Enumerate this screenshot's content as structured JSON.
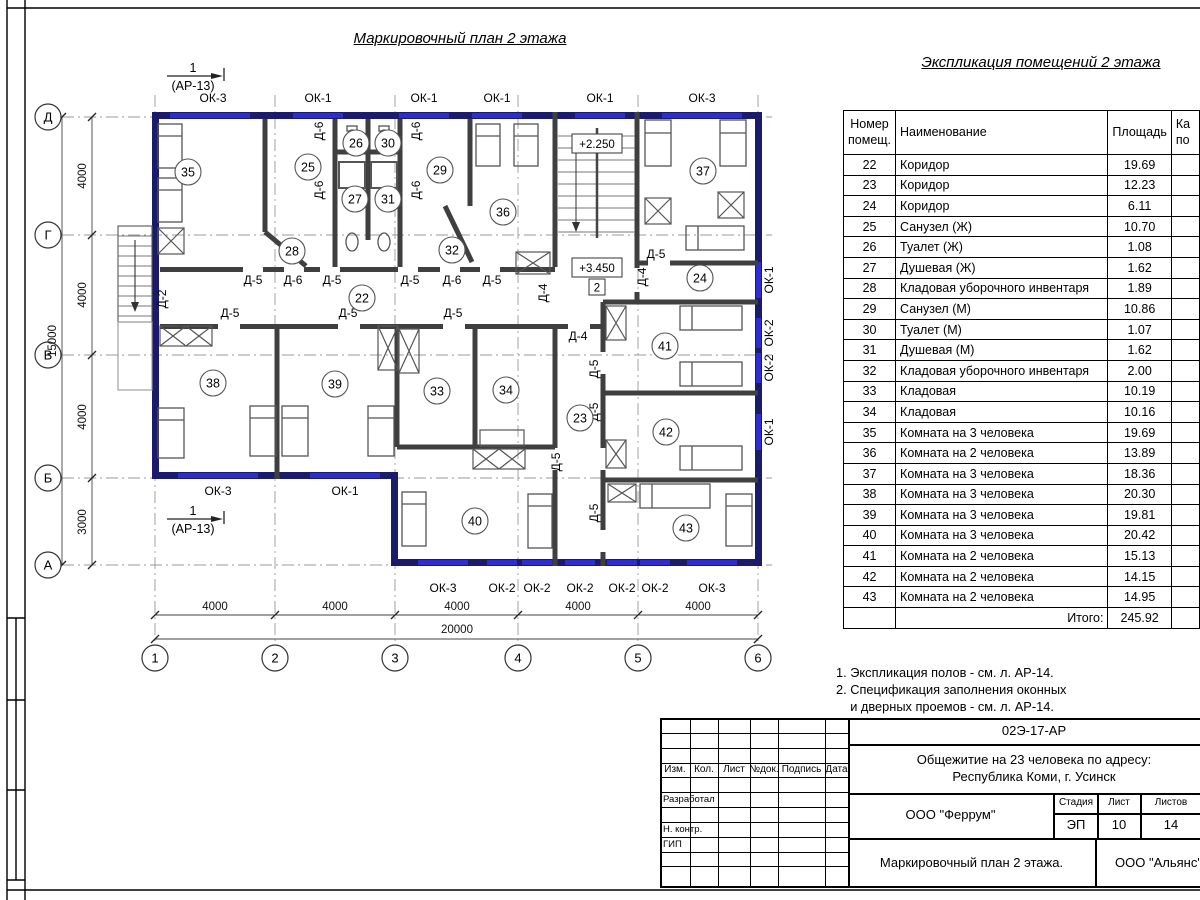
{
  "sheet": {
    "plan_title": "Маркировочный план 2 этажа",
    "schedule_title": "Экспликация помещений 2 этажа"
  },
  "plan": {
    "section_marker": {
      "num": "1",
      "ref": "(АР-13)",
      "positions": [
        {
          "x": 197,
          "y": 76
        },
        {
          "x": 197,
          "y": 519
        }
      ]
    },
    "axis_rows": [
      {
        "label": "Д",
        "y": 117
      },
      {
        "label": "Г",
        "y": 235
      },
      {
        "label": "В",
        "y": 355
      },
      {
        "label": "Б",
        "y": 478
      },
      {
        "label": "А",
        "y": 565
      }
    ],
    "axis_cols": [
      {
        "label": "1",
        "x": 155
      },
      {
        "label": "2",
        "x": 275
      },
      {
        "label": "3",
        "x": 395
      },
      {
        "label": "4",
        "x": 518
      },
      {
        "label": "5",
        "x": 638
      },
      {
        "label": "6",
        "x": 758
      }
    ],
    "dims_left_segments": [
      {
        "t": "4000",
        "y": 176
      },
      {
        "t": "4000",
        "y": 295
      },
      {
        "t": "4000",
        "y": 417
      },
      {
        "t": "3000",
        "y": 522
      }
    ],
    "dim_left_total": {
      "t": "15000",
      "x": 56,
      "y": 341
    },
    "dims_bottom_segments": [
      {
        "t": "4000",
        "x": 215
      },
      {
        "t": "4000",
        "x": 335
      },
      {
        "t": "4000",
        "x": 457
      },
      {
        "t": "4000",
        "x": 578
      },
      {
        "t": "4000",
        "x": 698
      }
    ],
    "dim_bottom_total": {
      "t": "20000",
      "x": 457,
      "y": 633
    },
    "rooms": [
      {
        "num": "35",
        "x": 188,
        "y": 172
      },
      {
        "num": "25",
        "x": 308,
        "y": 167
      },
      {
        "num": "26",
        "x": 356,
        "y": 143
      },
      {
        "num": "30",
        "x": 388,
        "y": 143
      },
      {
        "num": "27",
        "x": 355,
        "y": 199
      },
      {
        "num": "31",
        "x": 388,
        "y": 199
      },
      {
        "num": "29",
        "x": 440,
        "y": 170
      },
      {
        "num": "36",
        "x": 503,
        "y": 212
      },
      {
        "num": "28",
        "x": 292,
        "y": 251
      },
      {
        "num": "32",
        "x": 452,
        "y": 250
      },
      {
        "num": "22",
        "x": 362,
        "y": 298
      },
      {
        "num": "37",
        "x": 703,
        "y": 171
      },
      {
        "num": "24",
        "x": 700,
        "y": 278
      },
      {
        "num": "41",
        "x": 665,
        "y": 346
      },
      {
        "num": "42",
        "x": 666,
        "y": 432
      },
      {
        "num": "43",
        "x": 686,
        "y": 528
      },
      {
        "num": "40",
        "x": 475,
        "y": 521
      },
      {
        "num": "38",
        "x": 213,
        "y": 383
      },
      {
        "num": "39",
        "x": 335,
        "y": 384
      },
      {
        "num": "33",
        "x": 437,
        "y": 391
      },
      {
        "num": "34",
        "x": 506,
        "y": 390
      },
      {
        "num": "23",
        "x": 580,
        "y": 418
      }
    ],
    "window_labels": [
      {
        "t": "ОК-3",
        "x": 213,
        "y": 102
      },
      {
        "t": "ОК-1",
        "x": 318,
        "y": 102
      },
      {
        "t": "ОК-1",
        "x": 424,
        "y": 102
      },
      {
        "t": "ОК-1",
        "x": 497,
        "y": 102
      },
      {
        "t": "ОК-1",
        "x": 600,
        "y": 102
      },
      {
        "t": "ОК-3",
        "x": 702,
        "y": 102
      },
      {
        "t": "ОК-3",
        "x": 218,
        "y": 495
      },
      {
        "t": "ОК-1",
        "x": 345,
        "y": 495
      },
      {
        "t": "ОК-3",
        "x": 443,
        "y": 592
      },
      {
        "t": "ОК-2",
        "x": 502,
        "y": 592
      },
      {
        "t": "ОК-2",
        "x": 537,
        "y": 592
      },
      {
        "t": "ОК-2",
        "x": 580,
        "y": 592
      },
      {
        "t": "ОК-2",
        "x": 622,
        "y": 592
      },
      {
        "t": "ОК-2",
        "x": 655,
        "y": 592
      },
      {
        "t": "ОК-3",
        "x": 712,
        "y": 592
      },
      {
        "t": "ОК-1",
        "x": 773,
        "y": 280,
        "r": 1
      },
      {
        "t": "ОК-2",
        "x": 773,
        "y": 333,
        "r": 1
      },
      {
        "t": "ОК-2",
        "x": 773,
        "y": 368,
        "r": 1
      },
      {
        "t": "ОК-1",
        "x": 773,
        "y": 432,
        "r": 1
      }
    ],
    "door_labels": [
      {
        "t": "Д-5",
        "x": 253,
        "y": 284
      },
      {
        "t": "Д-6",
        "x": 293,
        "y": 284
      },
      {
        "t": "Д-5",
        "x": 332,
        "y": 284
      },
      {
        "t": "Д-5",
        "x": 410,
        "y": 284
      },
      {
        "t": "Д-6",
        "x": 452,
        "y": 284
      },
      {
        "t": "Д-5",
        "x": 492,
        "y": 284
      },
      {
        "t": "Д-5",
        "x": 230,
        "y": 317
      },
      {
        "t": "Д-5",
        "x": 348,
        "y": 317
      },
      {
        "t": "Д-5",
        "x": 453,
        "y": 317
      },
      {
        "t": "Д-5",
        "x": 656,
        "y": 258
      },
      {
        "t": "Д-4",
        "x": 578,
        "y": 340
      },
      {
        "t": "Д-6",
        "x": 323,
        "y": 131,
        "r": 1
      },
      {
        "t": "Д-6",
        "x": 420,
        "y": 131,
        "r": 1
      },
      {
        "t": "Д-6",
        "x": 323,
        "y": 190,
        "r": 1
      },
      {
        "t": "Д-6",
        "x": 420,
        "y": 190,
        "r": 1
      },
      {
        "t": "Д-2",
        "x": 166,
        "y": 299,
        "r": 1
      },
      {
        "t": "Д-4",
        "x": 547,
        "y": 293,
        "r": 1
      },
      {
        "t": "Д-4",
        "x": 646,
        "y": 277,
        "r": 1
      },
      {
        "t": "Д-5",
        "x": 598,
        "y": 369,
        "r": 1
      },
      {
        "t": "Д-5",
        "x": 598,
        "y": 412,
        "r": 1
      },
      {
        "t": "Д-5",
        "x": 560,
        "y": 462,
        "r": 1
      },
      {
        "t": "Д-5",
        "x": 598,
        "y": 513,
        "r": 1
      }
    ],
    "elevations": [
      {
        "t": "+2.250",
        "x": 597,
        "y": 144
      },
      {
        "t": "+3.450",
        "x": 597,
        "y": 268
      }
    ],
    "level_marker": {
      "t": "2",
      "x": 597,
      "y": 288
    }
  },
  "schedule": {
    "headers": {
      "num": "Номер\nпомещ.",
      "name": "Наименование",
      "area": "Площадь",
      "cut": "Ка\nпо"
    },
    "rows": [
      [
        "22",
        "Коридор",
        "19.69"
      ],
      [
        "23",
        "Коридор",
        "12.23"
      ],
      [
        "24",
        "Коридор",
        "6.11"
      ],
      [
        "25",
        "Санузел (Ж)",
        "10.70"
      ],
      [
        "26",
        "Туалет (Ж)",
        "1.08"
      ],
      [
        "27",
        "Душевая (Ж)",
        "1.62"
      ],
      [
        "28",
        "Кладовая уборочного инвентаря",
        "1.89"
      ],
      [
        "29",
        "Санузел (М)",
        "10.86"
      ],
      [
        "30",
        "Туалет (М)",
        "1.07"
      ],
      [
        "31",
        "Душевая (М)",
        "1.62"
      ],
      [
        "32",
        "Кладовая уборочного инвентаря",
        "2.00"
      ],
      [
        "33",
        "Кладовая",
        "10.19"
      ],
      [
        "34",
        "Кладовая",
        "10.16"
      ],
      [
        "35",
        "Комната на 3 человека",
        "19.69"
      ],
      [
        "36",
        "Комната на 2 человека",
        "13.89"
      ],
      [
        "37",
        "Комната на 3 человека",
        "18.36"
      ],
      [
        "38",
        "Комната на 3 человека",
        "20.30"
      ],
      [
        "39",
        "Комната на 3 человека",
        "19.81"
      ],
      [
        "40",
        "Комната на 3 человека",
        "20.42"
      ],
      [
        "41",
        "Комната на 2 человека",
        "15.13"
      ],
      [
        "42",
        "Комната на 2 человека",
        "14.15"
      ],
      [
        "43",
        "Комната на 2 человека",
        "14.95"
      ]
    ],
    "total_label": "Итого:",
    "total_value": "245.92"
  },
  "notes": [
    "1. Экспликация полов - см. л. АР-14.",
    "2. Спецификация заполнения оконных",
    "    и дверных проемов - см. л. АР-14."
  ],
  "title_block": {
    "code": "02Э-17-АР",
    "object_line1": "Общежитие на 23 человека по адресу:",
    "object_line2": "Республика Коми, г. Усинск",
    "org": "ООО \"Феррум\"",
    "stage_label": "Стадия",
    "sheet_label": "Лист",
    "sheets_label": "Листов",
    "stage": "ЭП",
    "sheet": "10",
    "sheets": "14",
    "doc_title": "Маркировочный план 2 этажа.",
    "org2": "ООО \"Альянс\"",
    "columns": [
      "Изм.",
      "Кол.",
      "Лист",
      "№док.",
      "Подпись",
      "Дата"
    ],
    "roles": [
      {
        "label": "Разработал",
        "row": 5
      },
      {
        "label": "Н. контр.",
        "row": 7
      },
      {
        "label": "ГИП",
        "row": 8
      }
    ]
  },
  "colors": {
    "exterior_wall": "#1b1b6b",
    "window": "#2d2dd0",
    "interior_wall": "#3f3f3f",
    "furniture": "#555555",
    "axis_line": "#9a9a9a"
  }
}
